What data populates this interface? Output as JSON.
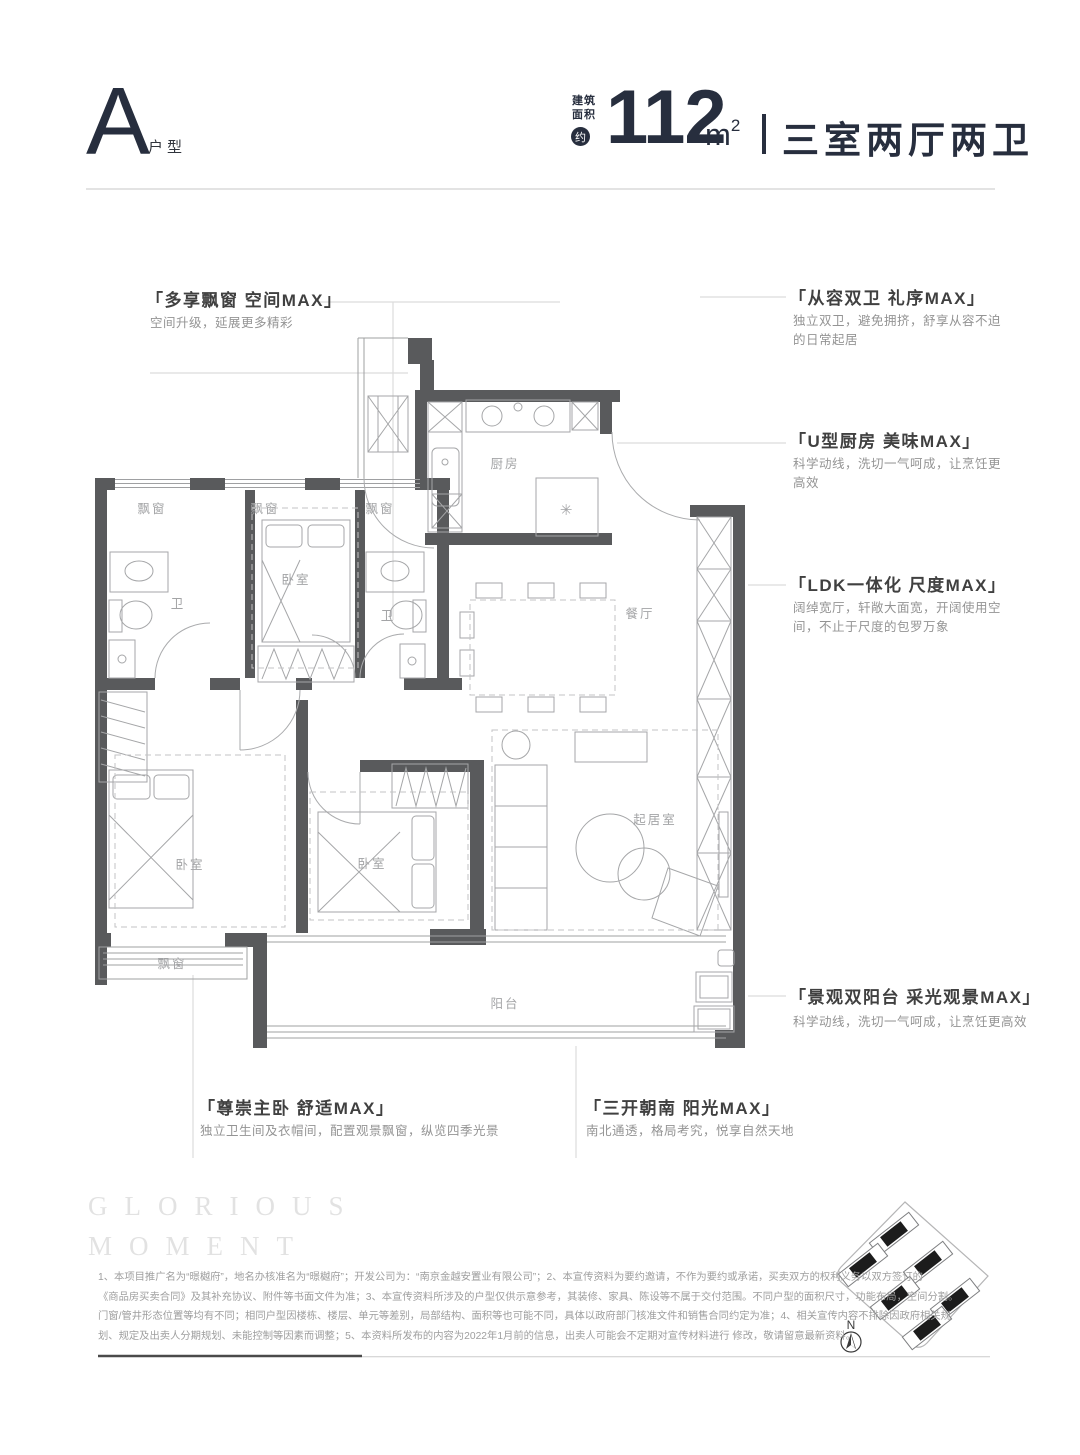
{
  "header": {
    "unit_letter": "A",
    "unit_type_label": "户型",
    "area_label_line1": "建筑",
    "area_label_line2": "面积",
    "approx_badge": "约",
    "area_value": "112",
    "area_unit_base": "m",
    "area_unit_sup": "2",
    "rooms_summary": "三室两厅两卫"
  },
  "annotations": {
    "bay_window": {
      "title": "「多享飘窗 空间MAX」",
      "desc": "空间升级，延展更多精彩"
    },
    "dual_bath": {
      "title": "「从容双卫 礼序MAX」",
      "desc_line1": "独立双卫，避免拥挤，舒享从容不迫",
      "desc_line2": "的日常起居"
    },
    "kitchen": {
      "title": "「U型厨房 美味MAX」",
      "desc_line1": "科学动线，洗切一气呵成，让烹饪更",
      "desc_line2": "高效"
    },
    "ldk": {
      "title": "「LDK一体化 尺度MAX」",
      "desc_line1": "阔绰宽厅，轩敞大面宽，开阔使用空",
      "desc_line2": "间，不止于尺度的包罗万象"
    },
    "balcony": {
      "title": "「景观双阳台 采光观景MAX」",
      "desc": "科学动线，洗切一气呵成，让烹饪更高效"
    },
    "master": {
      "title": "「尊崇主卧 舒适MAX」",
      "desc": "独立卫生间及衣帽间，配置观景飘窗，纵览四季光景"
    },
    "south": {
      "title": "「三开朝南 阳光MAX」",
      "desc": "南北通透，格局考究，悦享自然天地"
    }
  },
  "plan": {
    "rooms": {
      "bay_window": "飘窗",
      "bedroom": "卧室",
      "bathroom": "卫",
      "kitchen": "厨房",
      "dining": "餐厅",
      "living": "起居室",
      "balcony": "阳台",
      "fridge_symbol": "✳"
    }
  },
  "site_plan": {
    "north_label": "N"
  },
  "watermark": {
    "line1": "GLORIOUS",
    "line2": "MOMENT"
  },
  "disclaimer": {
    "line1": "1、本项目推广名为“暻樾府”，地名办核准名为“暻樾府”；开发公司为：“南京金越安置业有限公司”；2、本宣传资料为要约邀请，不作为要约或承诺，买卖双方的权利义务以双方签订的",
    "line2": "《商品房买卖合同》及其补充协议、附件等书面文件为准；3、本宣传资料所涉及的户型仅供示意参考，其装修、家具、陈设等不属于交付范围。不同户型的面积尺寸，功能布局，空间分割。",
    "line3": "门窗/管井形态位置等均有不同；相同户型因楼栋、楼层、单元等差别，局部结构、面积等也可能不同，具体以政府部门核准文件和销售合同约定为准；4、相关宣传内容不排除因政府相关规",
    "line4": "划、规定及出卖人分期规划、未能控制等因素而调整；5、本资料所发布的内容为2022年1月前的信息，出卖人可能会不定期对宣传材料进行 修改，敬请留意最新资料。"
  },
  "colors": {
    "accent_dark": "#272e3e",
    "wall": "#595a5c",
    "leader": "#dcdcdc"
  }
}
